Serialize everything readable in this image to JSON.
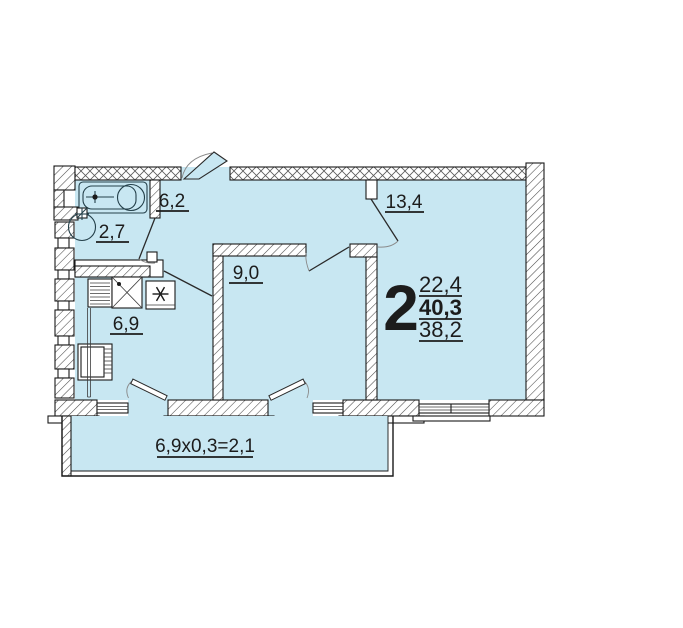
{
  "plan": {
    "rooms": [
      {
        "name": "hallway",
        "area": "6,2"
      },
      {
        "name": "bathroom",
        "area": "2,7"
      },
      {
        "name": "kitchen",
        "area": "6,9"
      },
      {
        "name": "bedroom",
        "area": "9,0"
      },
      {
        "name": "living-room",
        "area": "13,4"
      }
    ],
    "summary": {
      "rooms_count": "2",
      "living_area": "22,4",
      "total_area": "40,3",
      "area_without_balcony": "38,2"
    },
    "balcony": {
      "area_formula": "6,9x0,3=2,1"
    },
    "colors": {
      "floor_fill": "#c8e7f2",
      "wall_stroke": "#1a1a1a",
      "hatch": "#4a4a4a",
      "text": "#1c1c1c"
    }
  }
}
